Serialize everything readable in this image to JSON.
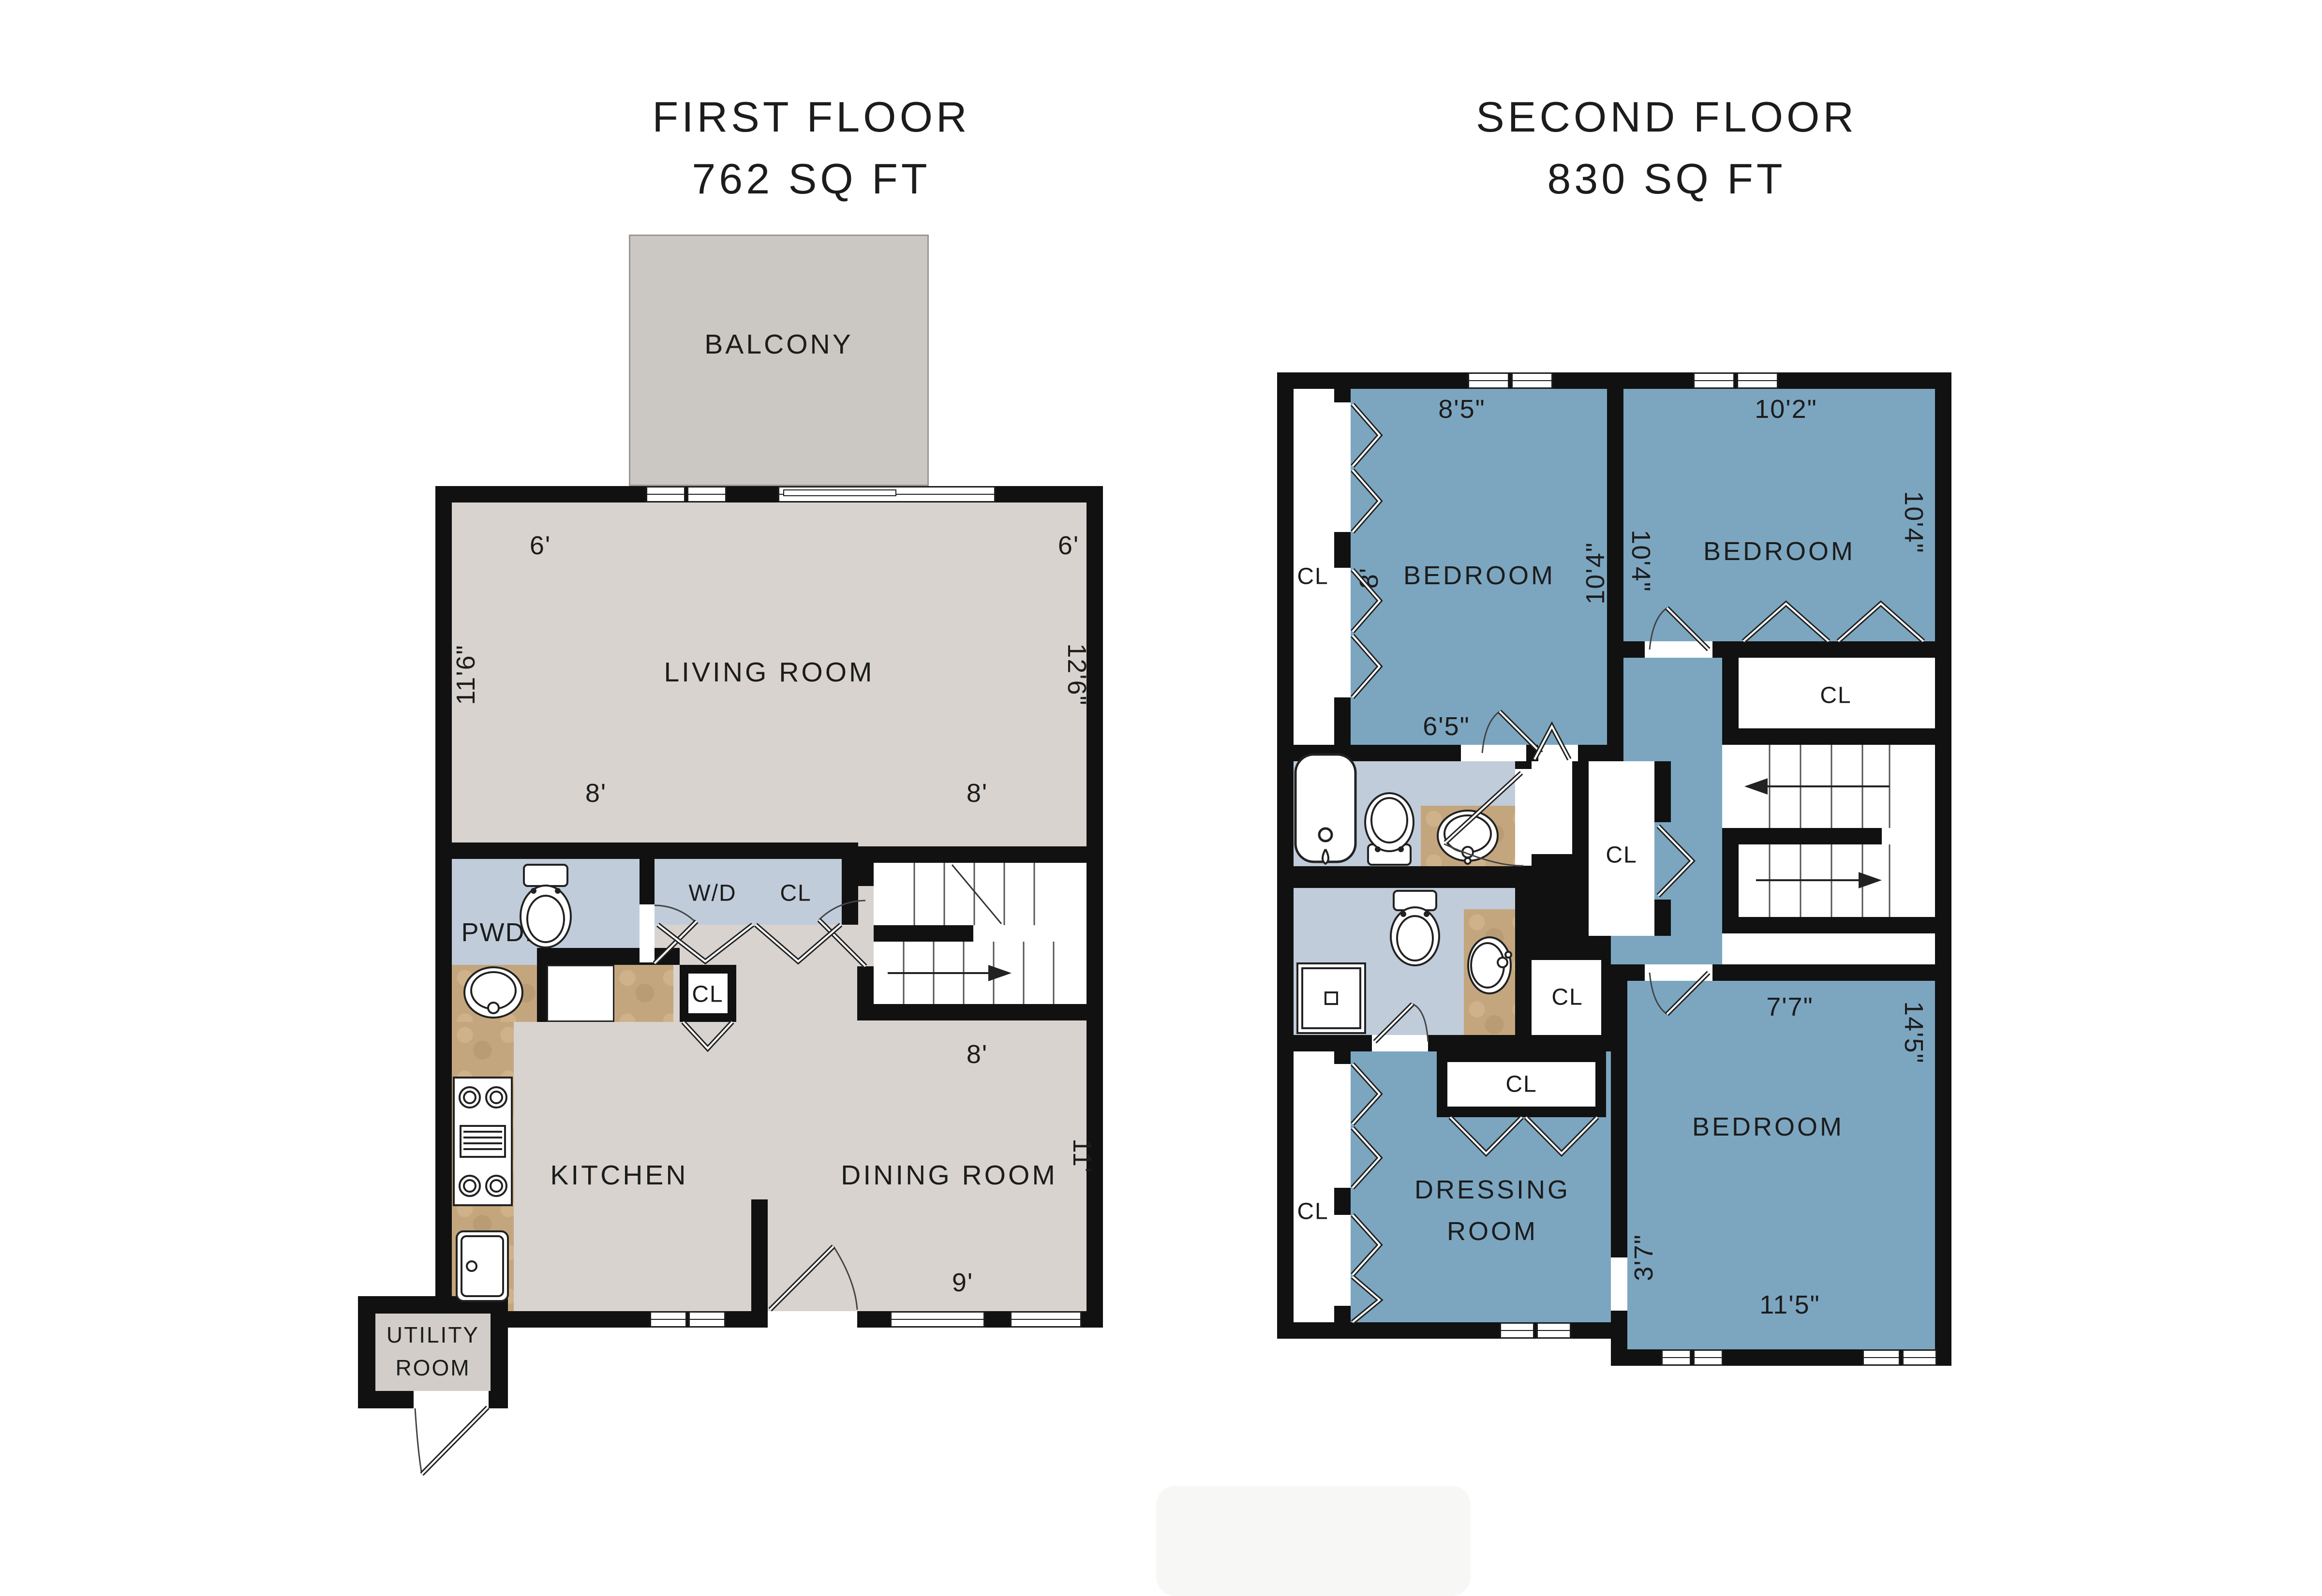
{
  "colors": {
    "wall": "#111111",
    "floor_gray": "#d8d3cf",
    "balcony_gray": "#cbc7c2",
    "room_blue": "#7ca6c0",
    "bath_blue": "#c0ccda",
    "counter_tan": "#c4a67e",
    "utility_gray": "#d2cdc8",
    "text": "#1c1c1c"
  },
  "labels": {
    "cl": "CL"
  },
  "first_floor": {
    "title": "FIRST FLOOR",
    "subtitle": "762 SQ FT",
    "balcony": "BALCONY",
    "living_room": "LIVING ROOM",
    "pwdr": "PWDR",
    "wd": "W/D",
    "kitchen": "KITCHEN",
    "dining_room": "DINING ROOM",
    "utility_line1": "UTILITY",
    "utility_line2": "ROOM",
    "dims": {
      "balcony_left": "6'",
      "balcony_right": "6'",
      "living_left": "11'6\"",
      "living_right": "12'6\"",
      "closet_band": "8'",
      "stairs_top": "8'",
      "stairs_bottom": "8'",
      "dining_bottom": "9'",
      "dining_right": "11'"
    }
  },
  "second_floor": {
    "title": "SECOND FLOOR",
    "subtitle": "830 SQ FT",
    "bedroom1": "BEDROOM",
    "bedroom2": "BEDROOM",
    "bedroom3": "BEDROOM",
    "dressing_line1": "DRESSING",
    "dressing_line2": "ROOM",
    "dims": {
      "bed1_top": "8'5\"",
      "bed1_left": "8'",
      "bed1_right": "10'4\"",
      "bed2_left": "10'4\"",
      "bed2_top": "10'2\"",
      "bed2_right": "10'4\"",
      "bed1_bottom": "6'5\"",
      "hall": "7'7\"",
      "bed3_left": "3'7\"",
      "bed3_right": "14'5\"",
      "bed3_bottom": "11'5\""
    }
  }
}
